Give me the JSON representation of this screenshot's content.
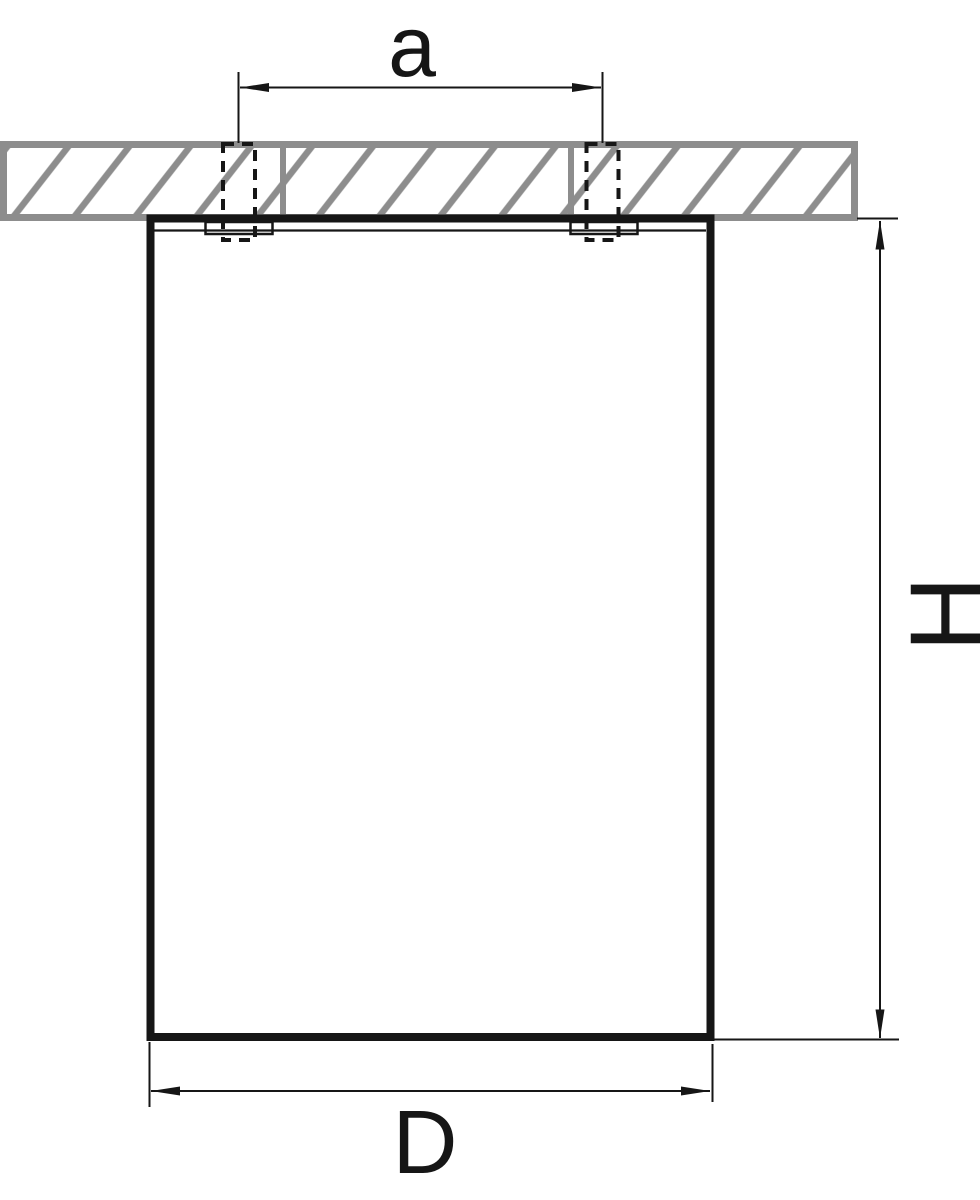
{
  "diagram": {
    "labels": {
      "spacing": "a",
      "height": "H",
      "diameter": "D"
    },
    "colors": {
      "line": "#161616",
      "hatch_gray": "#8d8d8d",
      "background": "#ffffff"
    }
  }
}
